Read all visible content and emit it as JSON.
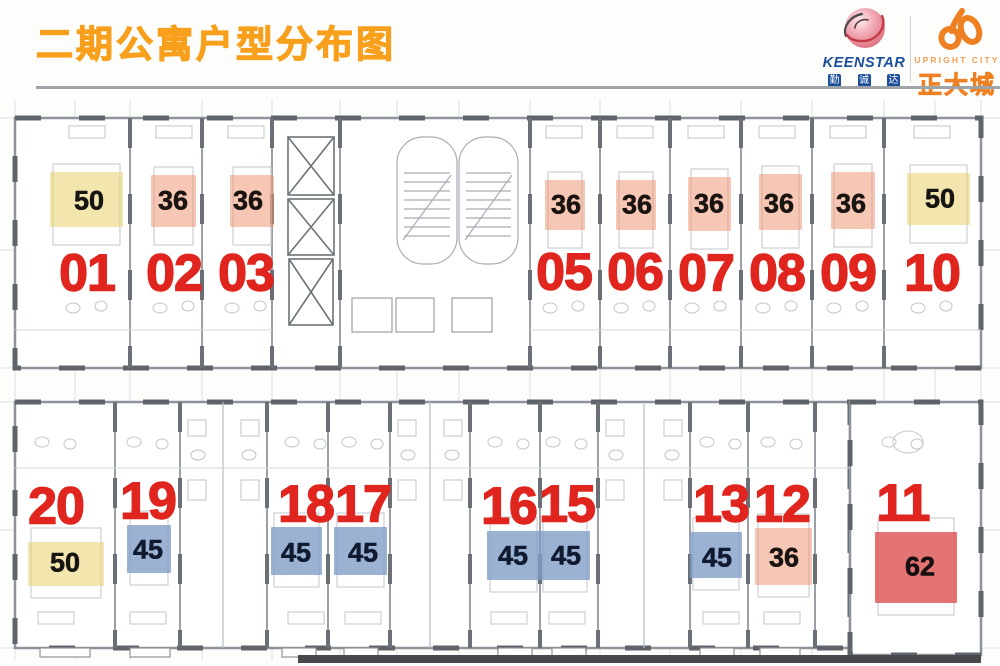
{
  "header": {
    "title": "二期公寓户型分布图",
    "title_color": "#f8a01c"
  },
  "logos": {
    "keenstar": {
      "name": "KEENSTAR",
      "cn_chars": [
        "勤",
        "诚",
        "达"
      ],
      "text_color": "#1b4e9b"
    },
    "upright_city": {
      "en_name": "UPRIGHT CITY",
      "cn_name": "正大城",
      "color": "#ee8022",
      "en_color": "#f0a057"
    }
  },
  "floorplan": {
    "unit_number_color": "#e0251f",
    "area_colors": {
      "50": "#e9d06c",
      "36": "#f0906c",
      "45": "#7f9cc7",
      "62": "#dc4848"
    },
    "area_opacity": {
      "50": 0.55,
      "36": 0.5,
      "45": 0.78,
      "62": 0.76
    },
    "area_text_colors": {
      "50": "#171512",
      "36": "#1a1410",
      "45": "#101a30",
      "62": "#171010"
    },
    "units": [
      {
        "no": "01",
        "area": "50",
        "row": "top",
        "num": [
          87,
          272
        ],
        "patch": [
          50,
          172,
          73,
          55
        ],
        "label": [
          89,
          200
        ]
      },
      {
        "no": "02",
        "area": "36",
        "row": "top",
        "num": [
          174,
          272
        ],
        "patch": [
          151,
          175,
          45,
          52
        ],
        "label": [
          173,
          200
        ]
      },
      {
        "no": "03",
        "area": "36",
        "row": "top",
        "num": [
          246,
          272
        ],
        "patch": [
          230,
          175,
          44,
          52
        ],
        "label": [
          248,
          200
        ]
      },
      {
        "no": "05",
        "area": "36",
        "row": "top",
        "num": [
          564,
          271
        ],
        "patch": [
          545,
          180,
          40,
          50
        ],
        "label": [
          566,
          204
        ]
      },
      {
        "no": "06",
        "area": "36",
        "row": "top",
        "num": [
          635,
          271
        ],
        "patch": [
          616,
          180,
          40,
          50
        ],
        "label": [
          637,
          204
        ]
      },
      {
        "no": "07",
        "area": "36",
        "row": "top",
        "num": [
          706,
          272
        ],
        "patch": [
          688,
          177,
          43,
          54
        ],
        "label": [
          709,
          203
        ]
      },
      {
        "no": "08",
        "area": "36",
        "row": "top",
        "num": [
          777,
          272
        ],
        "patch": [
          759,
          174,
          43,
          56
        ],
        "label": [
          779,
          203
        ]
      },
      {
        "no": "09",
        "area": "36",
        "row": "top",
        "num": [
          848,
          272
        ],
        "patch": [
          831,
          172,
          44,
          57
        ],
        "label": [
          851,
          203
        ]
      },
      {
        "no": "10",
        "area": "50",
        "row": "top",
        "num": [
          932,
          272
        ],
        "patch": [
          907,
          173,
          63,
          52
        ],
        "label": [
          940,
          198
        ]
      },
      {
        "no": "20",
        "area": "50",
        "row": "bottom",
        "num": [
          56,
          505
        ],
        "patch": [
          28,
          542,
          76,
          44
        ],
        "label": [
          65,
          562
        ]
      },
      {
        "no": "19",
        "area": "45",
        "row": "bottom",
        "num": [
          148,
          500
        ],
        "patch": [
          127,
          525,
          44,
          48
        ],
        "label": [
          148,
          549
        ]
      },
      {
        "no": "18",
        "area": "45",
        "row": "bottom",
        "num": [
          306,
          503
        ],
        "patch": [
          271,
          527,
          51,
          48
        ],
        "label": [
          296,
          552
        ]
      },
      {
        "no": "17",
        "area": "45",
        "row": "bottom",
        "num": [
          363,
          503
        ],
        "patch": [
          334,
          527,
          53,
          48
        ],
        "label": [
          363,
          552
        ]
      },
      {
        "no": "16",
        "area": "45",
        "row": "bottom",
        "num": [
          509,
          505
        ],
        "patch": [
          487,
          531,
          53,
          49
        ],
        "label": [
          513,
          555
        ]
      },
      {
        "no": "15",
        "area": "45",
        "row": "bottom",
        "num": [
          567,
          503
        ],
        "patch": [
          540,
          531,
          50,
          49
        ],
        "label": [
          566,
          555
        ]
      },
      {
        "no": "13",
        "area": "45",
        "row": "bottom",
        "num": [
          721,
          503
        ],
        "patch": [
          690,
          532,
          52,
          46
        ],
        "label": [
          717,
          557
        ]
      },
      {
        "no": "12",
        "area": "36",
        "row": "bottom",
        "num": [
          782,
          503
        ],
        "patch": [
          755,
          528,
          57,
          57
        ],
        "label": [
          784,
          557
        ]
      },
      {
        "no": "11",
        "area": "62",
        "row": "bottom",
        "num": [
          903,
          502
        ],
        "patch": [
          875,
          532,
          82,
          71
        ],
        "label": [
          920,
          566
        ]
      }
    ]
  }
}
